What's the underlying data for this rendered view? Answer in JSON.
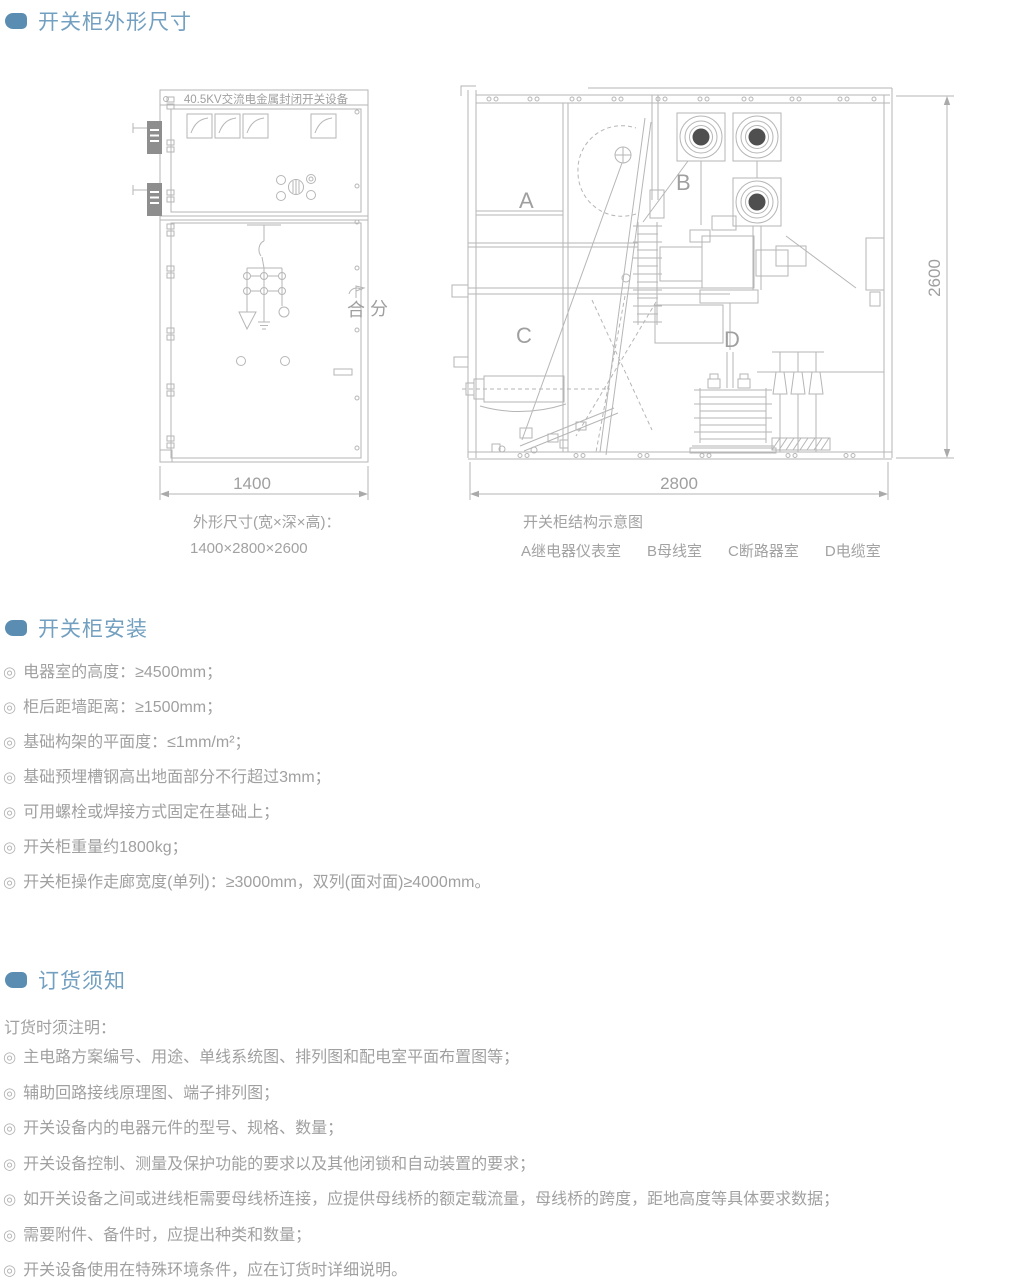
{
  "page": {
    "bullet_glyph": "◎"
  },
  "colors": {
    "accent": "#5b8db2",
    "heading_text": "#73a0c0",
    "body_text": "#a0a0a0",
    "drawing_line": "#b6b6b6"
  },
  "section_dimensions": {
    "title": "开关柜外形尺寸",
    "cabinet_front": {
      "nameplate": "40.5KV交流电金属封闭开关设备",
      "close_label": "合",
      "open_label": "分",
      "width_dim": "1400"
    },
    "cabinet_section": {
      "compartment_a": "A",
      "compartment_b": "B",
      "compartment_c": "C",
      "compartment_d": "D",
      "depth_dim": "2800",
      "height_dim": "2600"
    },
    "caption_left": {
      "line1": "外形尺寸(宽×深×高)：",
      "line2": "1400×2800×2600"
    },
    "caption_right": {
      "line1": "开关柜结构示意图",
      "legend": [
        "A继电器仪表室",
        "B母线室",
        "C断路器室",
        "D电缆室"
      ]
    }
  },
  "section_install": {
    "title": "开关柜安装",
    "items": [
      "电器室的高度：≥4500mm；",
      "柜后距墙距离：≥1500mm；",
      "基础构架的平面度：≤1mm/m²；",
      "基础预埋槽钢高出地面部分不行超过3mm；",
      "可用螺栓或焊接方式固定在基础上；",
      "开关柜重量约1800kg；",
      "开关柜操作走廊宽度(单列)：≥3000mm，双列(面对面)≥4000mm。"
    ]
  },
  "section_order": {
    "title": "订货须知",
    "intro": "订货时须注明：",
    "items": [
      "主电路方案编号、用途、单线系统图、排列图和配电室平面布置图等；",
      "辅助回路接线原理图、端子排列图；",
      "开关设备内的电器元件的型号、规格、数量；",
      "开关设备控制、测量及保护功能的要求以及其他闭锁和自动装置的要求；",
      "如开关设备之间或进线柜需要母线桥连接，应提供母线桥的额定载流量，母线桥的跨度，距地高度等具体要求数据；",
      "需要附件、备件时，应提出种类和数量；",
      "开关设备使用在特殊环境条件，应在订货时详细说明。"
    ]
  }
}
